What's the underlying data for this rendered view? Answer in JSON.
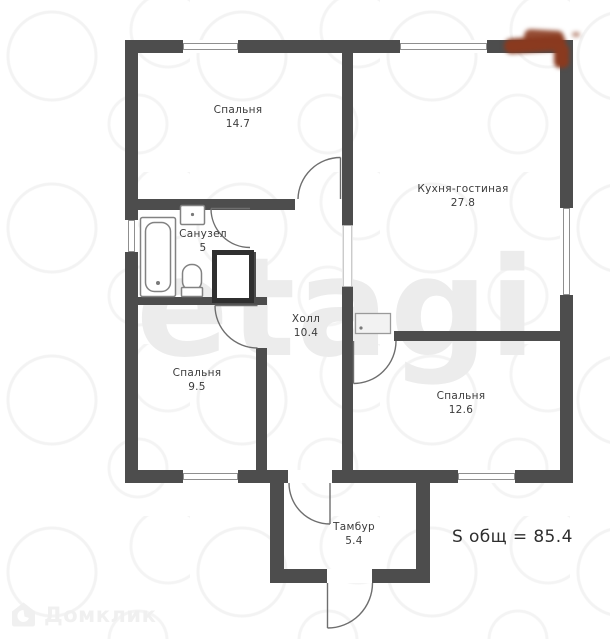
{
  "rooms": [
    {
      "name": "Спальня",
      "area": "14.7"
    },
    {
      "name": "Кухня-гостиная",
      "area": "27.8"
    },
    {
      "name": "Санузел",
      "area": "5"
    },
    {
      "name": "Холл",
      "area": "10.4"
    },
    {
      "name": "Спальня",
      "area": "9.5"
    },
    {
      "name": "Спальня",
      "area": "12.6"
    },
    {
      "name": "Тамбур",
      "area": "5.4"
    }
  ],
  "total_area": "S общ = 85.4",
  "watermarks": {
    "center": "etagi",
    "bottom_left": "Домклик"
  },
  "colors": {
    "wall": "#4d4d4d",
    "text": "#3b3b3b",
    "frame_line": "#8f8f8f",
    "watermark": "#ececec",
    "logo_red": "#8a3a1f"
  }
}
